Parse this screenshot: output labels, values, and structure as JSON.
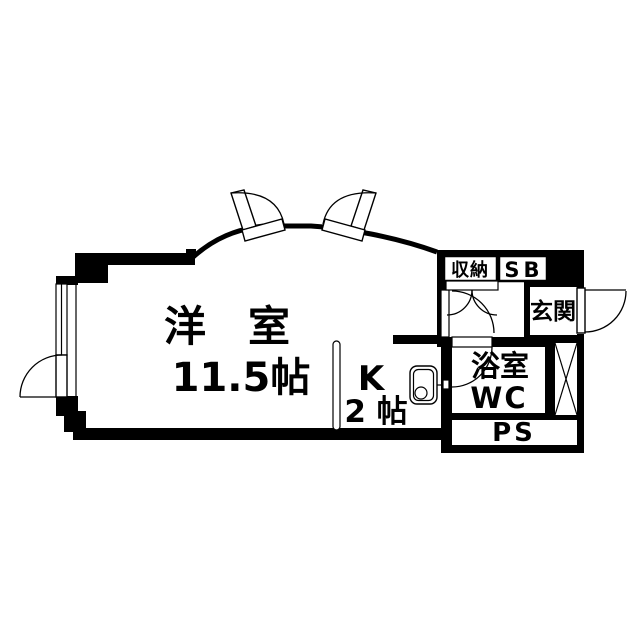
{
  "colors": {
    "ink": "#000000",
    "background": "#ffffff"
  },
  "floorplan": {
    "type": "apartment-floor-plan",
    "rooms": {
      "western_room": {
        "label": "洋　室",
        "size": "11.5帖"
      },
      "kitchen": {
        "label": "K",
        "size": "2 帖"
      },
      "storage": {
        "label": "収納"
      },
      "shoe_box": {
        "label": "SB"
      },
      "entrance": {
        "label": "玄関"
      },
      "bathroom": {
        "label": "浴室",
        "sublabel": "WC"
      },
      "pipe_space": {
        "label": "PS"
      }
    }
  }
}
